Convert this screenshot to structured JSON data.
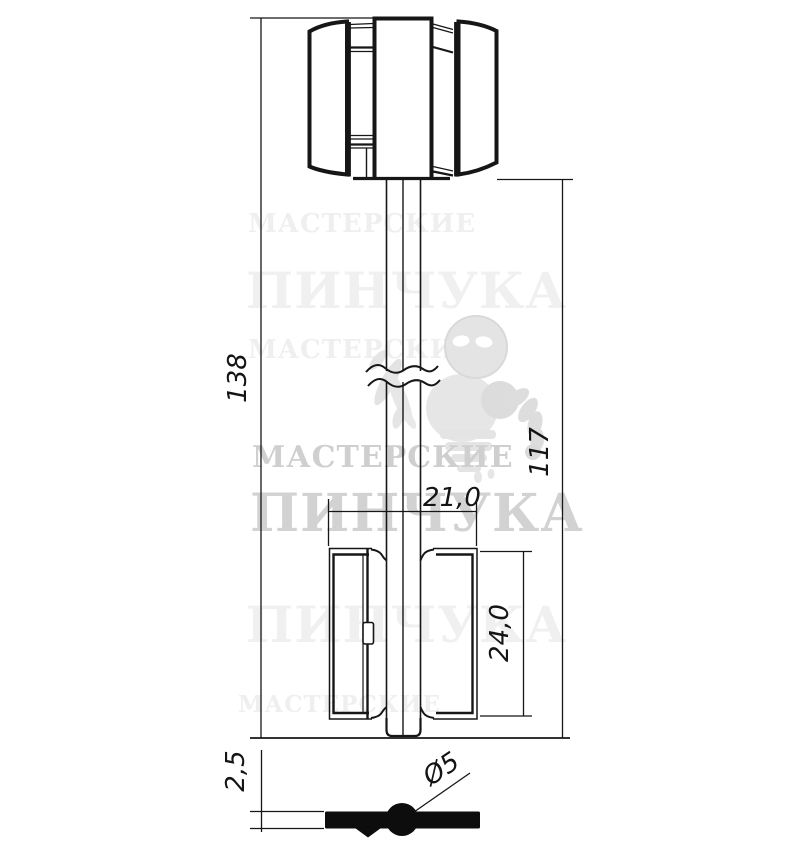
{
  "drawing": {
    "subject": "lever-lock key blank technical drawing",
    "line_color": "#161616",
    "background": "#ffffff",
    "dims": {
      "total_length": "138",
      "shaft_length": "117",
      "bit_width": "21,0",
      "bit_height": "24,0",
      "bit_thickness": "2,5",
      "shaft_diameter": "Ø5"
    }
  },
  "watermark": {
    "line1": "МАСТЕРСКИЕ",
    "line2": "ПИНЧУКА",
    "mascot": "ghost-mascot-icon",
    "color_strong": "#d2d2d2",
    "color_faint": "#efefef"
  }
}
